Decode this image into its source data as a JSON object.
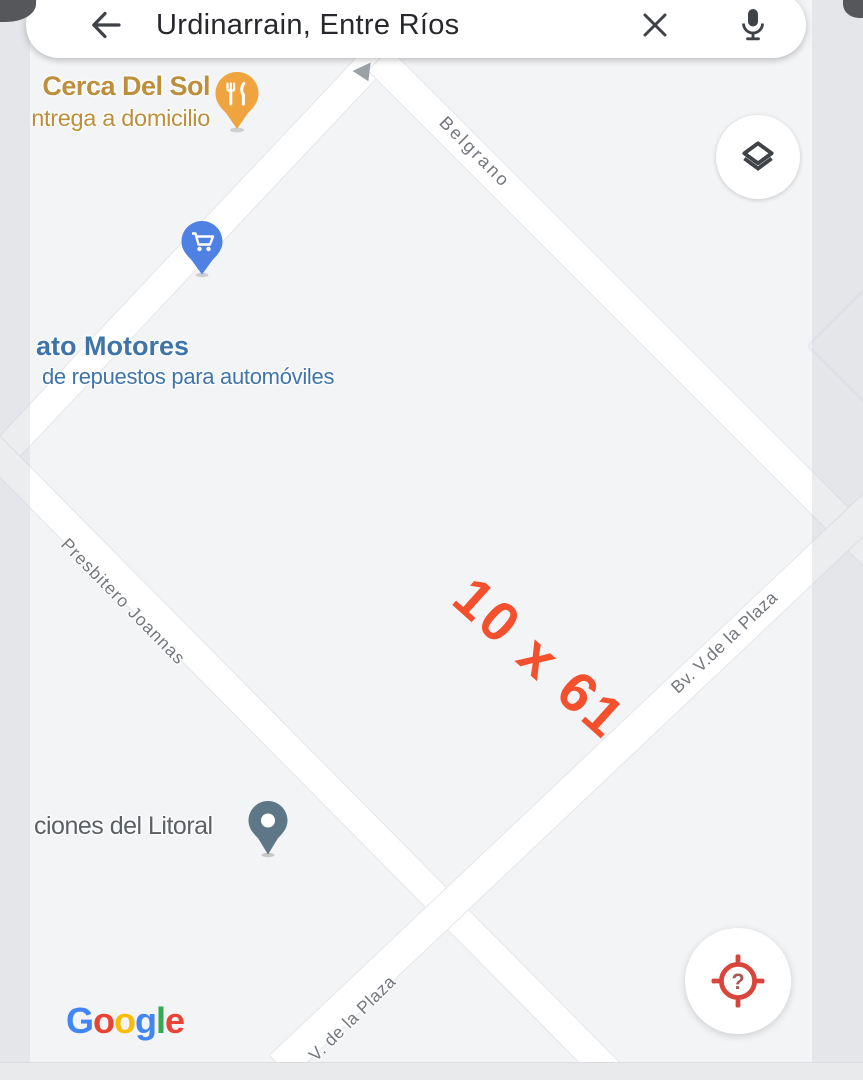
{
  "search_bar": {
    "query": "Urdinarrain, Entre Ríos",
    "back_icon": "arrow-left",
    "clear_icon": "close",
    "mic_icon": "microphone"
  },
  "streets": [
    {
      "name": "Belgrano"
    },
    {
      "name": "Presbitero Joannas"
    },
    {
      "name": "Bv. V.de la Plaza"
    },
    {
      "name": "V. de la Plaza"
    }
  ],
  "pois": [
    {
      "name": "Cerca Del Sol",
      "detail": "ntrega a domicilio",
      "type": "restaurant",
      "text_color": "#BD8E3B",
      "pin_color": "#F0A43F"
    },
    {
      "name": "ato Motores",
      "detail": "de repuestos para automóviles",
      "type": "shopping",
      "text_color": "#3F74A9",
      "pin_color": "#4F81E5"
    },
    {
      "name": "ciones del Litoral",
      "detail": "",
      "type": "place",
      "text_color": "#5B6065",
      "pin_color": "#5E7787"
    }
  ],
  "annotation": {
    "text": "10 x 61",
    "color": "#F5502D"
  },
  "controls": {
    "layers_icon": "layers",
    "locate_icon": "my-location-searching",
    "locate_glyph": "?"
  },
  "attribution": {
    "name": "Google",
    "letters": [
      {
        "ch": "G",
        "color": "#4285F4"
      },
      {
        "ch": "o",
        "color": "#EA4335"
      },
      {
        "ch": "o",
        "color": "#FBBC05"
      },
      {
        "ch": "g",
        "color": "#4285F4"
      },
      {
        "ch": "l",
        "color": "#34A853"
      },
      {
        "ch": "e",
        "color": "#EA4335"
      }
    ]
  },
  "colors": {
    "map_background": "#F3F4F6",
    "road_fill": "#FFFFFF",
    "road_edge": "#E4E6E9",
    "street_label": "#73777D",
    "locate_red": "#D9453A",
    "icon_dark": "#3F4246"
  }
}
